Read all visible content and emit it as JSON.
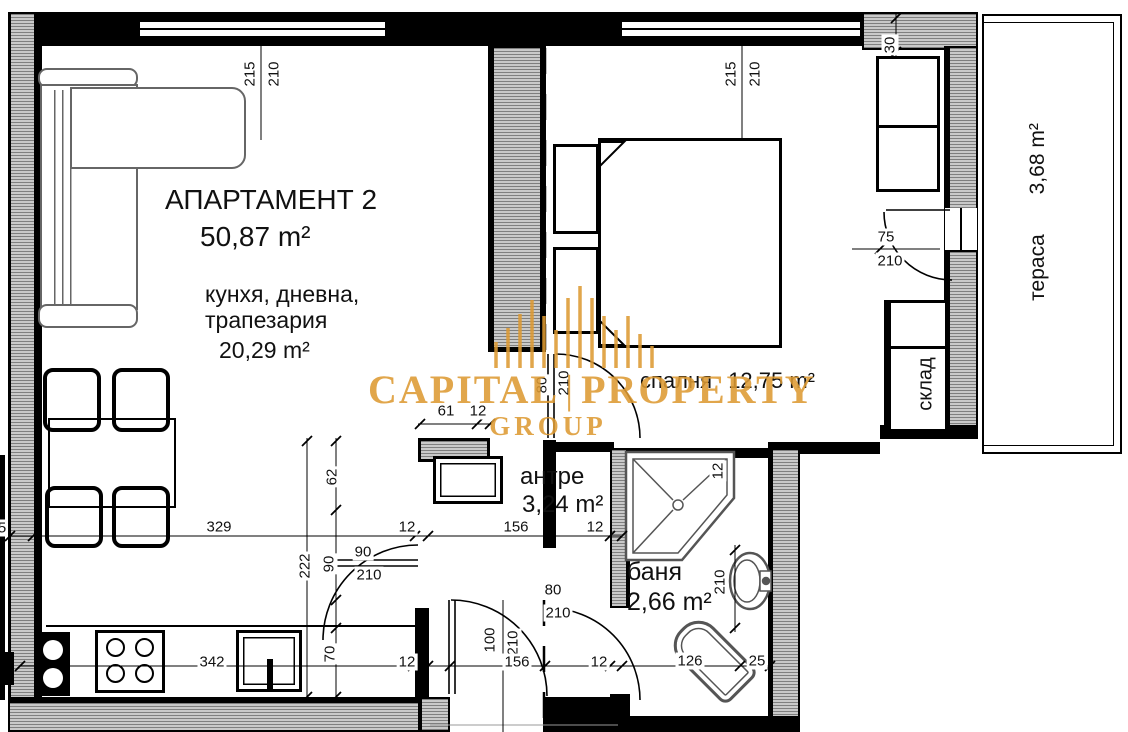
{
  "title": {
    "name": "АПАРТАМЕНТ 2",
    "area": "50,87 m²"
  },
  "rooms": {
    "living": {
      "label_line1": "кунхя, дневна,",
      "label_line2": "трапезария",
      "area": "20,29 m²"
    },
    "bedroom": {
      "label": "спалня",
      "area": "12,75 m²"
    },
    "hall": {
      "label": "антре",
      "area": "3,24 m²"
    },
    "bath": {
      "label": "баня",
      "area": "2,66 m²"
    },
    "terrace": {
      "label": "тераса",
      "area": "3,68 m²"
    },
    "storage": {
      "label": "склад"
    }
  },
  "watermark": {
    "word1": "CAPITAL",
    "separator": "|",
    "word2": "PROPERTY",
    "word3": "GROUP",
    "color": "#DD9A33"
  },
  "colors": {
    "wall": "#000000",
    "hatch": "#c9c9c9",
    "furniture_outline": "#666666",
    "watermark": "#DD9A33"
  },
  "dimensions": [
    {
      "t": "215",
      "x": 250,
      "y": 74,
      "r": -90
    },
    {
      "t": "210",
      "x": 274,
      "y": 74,
      "r": -90
    },
    {
      "t": "215",
      "x": 731,
      "y": 74,
      "r": -90
    },
    {
      "t": "210",
      "x": 755,
      "y": 74,
      "r": -90
    },
    {
      "t": "30",
      "x": 890,
      "y": 45,
      "r": -90
    },
    {
      "t": "75",
      "x": 886,
      "y": 237,
      "r": 0
    },
    {
      "t": "210",
      "x": 890,
      "y": 261,
      "r": 0
    },
    {
      "t": "80",
      "x": 542,
      "y": 385,
      "r": -90
    },
    {
      "t": "210",
      "x": 564,
      "y": 383,
      "r": -90
    },
    {
      "t": "61",
      "x": 446,
      "y": 411,
      "r": 0
    },
    {
      "t": "12",
      "x": 478,
      "y": 411,
      "r": 0
    },
    {
      "t": "12",
      "x": 718,
      "y": 471,
      "r": -90
    },
    {
      "t": "5",
      "x": 2,
      "y": 528,
      "r": 0
    },
    {
      "t": "329",
      "x": 219,
      "y": 527,
      "r": 0
    },
    {
      "t": "12",
      "x": 407,
      "y": 527,
      "r": 0
    },
    {
      "t": "156",
      "x": 516,
      "y": 527,
      "r": 0
    },
    {
      "t": "12",
      "x": 595,
      "y": 527,
      "r": 0
    },
    {
      "t": "62",
      "x": 332,
      "y": 477,
      "r": -90
    },
    {
      "t": "222",
      "x": 305,
      "y": 566,
      "r": -90
    },
    {
      "t": "90",
      "x": 329,
      "y": 564,
      "r": -90
    },
    {
      "t": "90",
      "x": 363,
      "y": 552,
      "r": 0
    },
    {
      "t": "210",
      "x": 369,
      "y": 575,
      "r": 0
    },
    {
      "t": "80",
      "x": 553,
      "y": 590,
      "r": 0
    },
    {
      "t": "210",
      "x": 558,
      "y": 613,
      "r": 0
    },
    {
      "t": "210",
      "x": 720,
      "y": 582,
      "r": -90
    },
    {
      "t": "342",
      "x": 212,
      "y": 662,
      "r": 0
    },
    {
      "t": "70",
      "x": 330,
      "y": 654,
      "r": -90
    },
    {
      "t": "12",
      "x": 407,
      "y": 662,
      "r": 0
    },
    {
      "t": "100",
      "x": 490,
      "y": 640,
      "r": -90
    },
    {
      "t": "210",
      "x": 513,
      "y": 643,
      "r": -90
    },
    {
      "t": "156",
      "x": 517,
      "y": 662,
      "r": 0
    },
    {
      "t": "12",
      "x": 599,
      "y": 662,
      "r": 0
    },
    {
      "t": "126",
      "x": 690,
      "y": 661,
      "r": 0
    },
    {
      "t": "25",
      "x": 757,
      "y": 661,
      "r": 0
    }
  ]
}
